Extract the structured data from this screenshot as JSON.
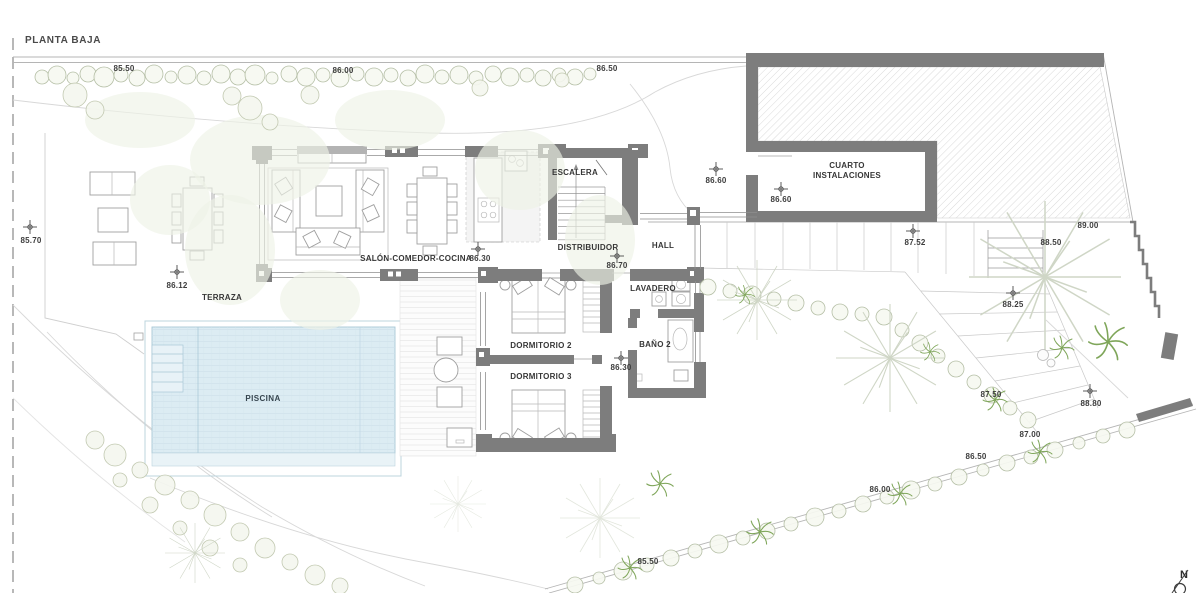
{
  "title": "PLANTA BAJA",
  "colors": {
    "wall_gray": "#7d7d7d",
    "pool_water": "#dcecf3",
    "vegetation_green": "#b5bfa6",
    "plant_green": "#7fa65a",
    "text": "#373737"
  },
  "rooms": {
    "salon": "SALÓN-COMEDOR-COCINA",
    "escalera": "ESCALERA",
    "distribuidor": "DISTRIBUIDOR",
    "hall": "HALL",
    "lavadero": "LAVADERO",
    "bano2": "BAÑO 2",
    "dormitorio2": "DORMITORIO 2",
    "dormitorio3": "DORMITORIO 3",
    "cuarto_line1": "CUARTO",
    "cuarto_line2": "INSTALACIONES",
    "terraza": "TERRAZA",
    "piscina": "PISCINA"
  },
  "levels": {
    "top_8550": "85.50",
    "top_8600": "86.00",
    "top_8650": "86.50",
    "left_8570": "85.70",
    "terraza_8612": "86.12",
    "salon_8630": "86.30",
    "distribuidor_8670": "86.70",
    "patio_8660": "86.60",
    "cuarto_8660": "86.60",
    "dorm_8630": "86.30",
    "drive_8900": "89.00",
    "steps_8850": "88.50",
    "path_8752": "87.52",
    "garden_8825": "88.25",
    "garden_8750": "87.50",
    "garden_8880": "88.80",
    "bound_8700": "87.00",
    "bound_8650": "86.50",
    "bound_8600": "86.00",
    "bound_8550": "85.50"
  },
  "compass": {
    "north": "N"
  }
}
